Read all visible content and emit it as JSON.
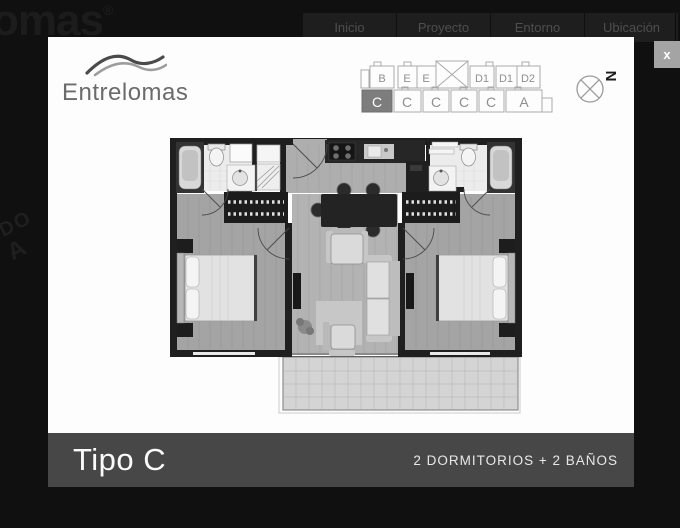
{
  "background": {
    "logo_text": "omas",
    "logo_reg": "®",
    "watermark_line1": "ADO",
    "watermark_line2": "A"
  },
  "nav": {
    "items": [
      "Inicio",
      "Proyecto",
      "Entorno",
      "Ubicación"
    ]
  },
  "modal": {
    "close_label": "x",
    "brand": {
      "name": "Entrelomas"
    },
    "unit_map": {
      "top": [
        "B",
        "E",
        "E",
        "D1",
        "D1",
        "D2"
      ],
      "bottom": [
        "C",
        "C",
        "C",
        "C",
        "C",
        "A"
      ],
      "selected": "C"
    },
    "compass": {
      "north": "N"
    },
    "footer": {
      "title": "Tipo C",
      "subtitle": "2 DORMITORIOS + 2 BAÑOS"
    }
  },
  "colors": {
    "page_bg": "#101010",
    "modal_bg": "#fdfdfd",
    "footer_bar": "#474747",
    "selected_unit": "#7d7d7d",
    "wall": "#1f1f1f"
  }
}
